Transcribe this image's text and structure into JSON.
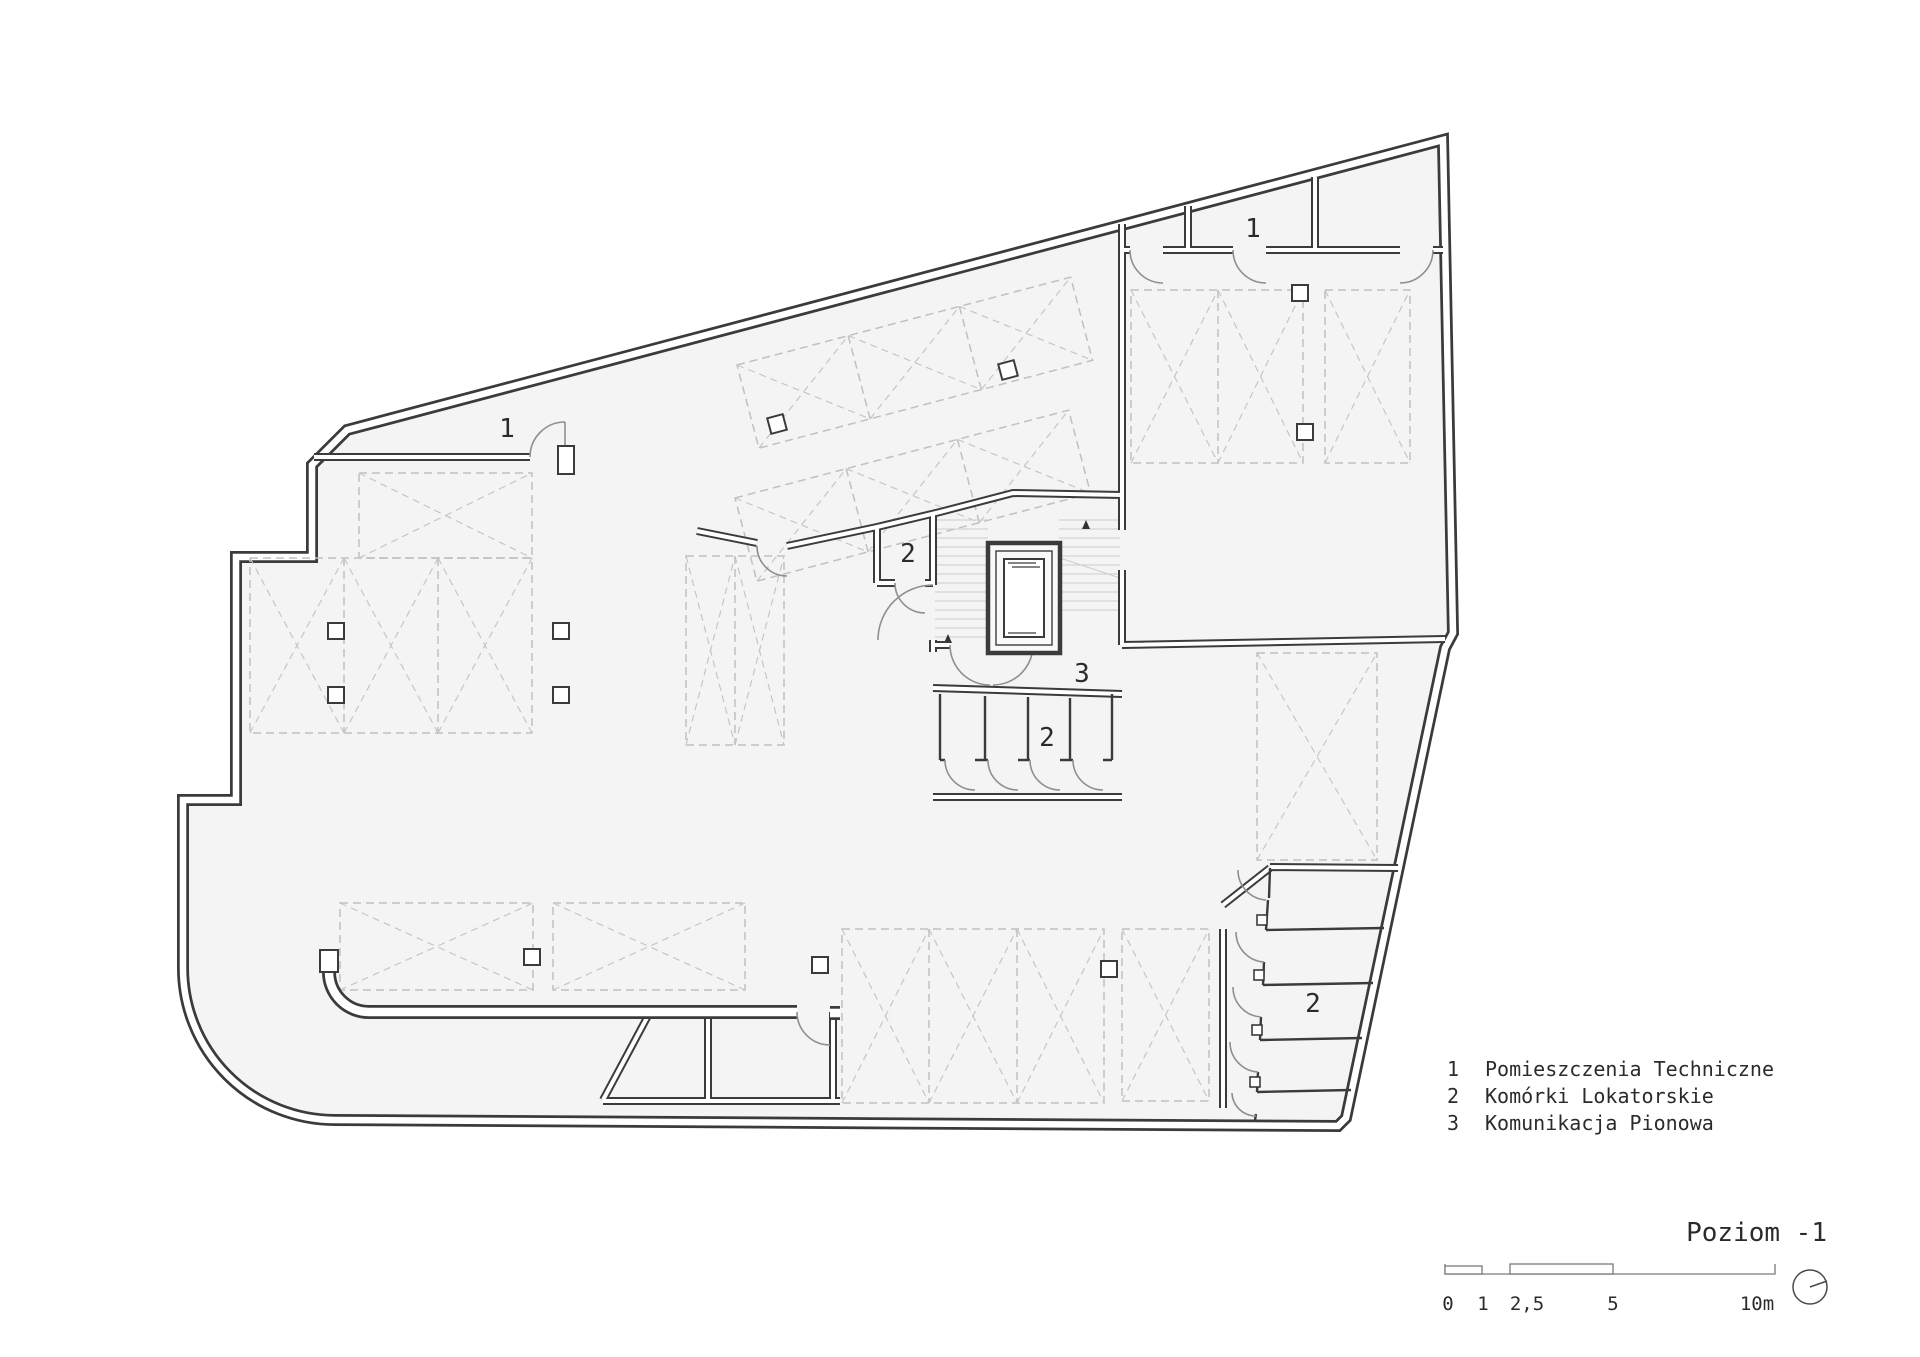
{
  "title": {
    "text": "Poziom -1"
  },
  "legend": {
    "items": [
      {
        "num": "1",
        "label": "Pomieszczenia Techniczne"
      },
      {
        "num": "2",
        "label": "Komórki Lokatorskie"
      },
      {
        "num": "3",
        "label": "Komunikacja Pionowa"
      }
    ]
  },
  "plan_labels": [
    {
      "text": "1",
      "x": 507,
      "y": 437
    },
    {
      "text": "1",
      "x": 1253,
      "y": 237
    },
    {
      "text": "2",
      "x": 908,
      "y": 562
    },
    {
      "text": "3",
      "x": 1082,
      "y": 682
    },
    {
      "text": "2",
      "x": 1047,
      "y": 746
    },
    {
      "text": "2",
      "x": 1313,
      "y": 1012
    }
  ],
  "scale_bar": {
    "ticks": [
      {
        "label": "0",
        "x": 1448
      },
      {
        "label": "1",
        "x": 1483
      },
      {
        "label": "2,5",
        "x": 1527
      },
      {
        "label": "5",
        "x": 1613
      },
      {
        "label": "10m",
        "x": 1757
      }
    ]
  },
  "north_indicator": {
    "icon": "north-indicator-icon"
  },
  "colors": {
    "wall": "#3b3b3b",
    "floor": "#f4f4f4",
    "dash": "#c0c0c0",
    "text": "#2b2b2b",
    "door": "#8f8f8f",
    "background": "#ffffff"
  }
}
